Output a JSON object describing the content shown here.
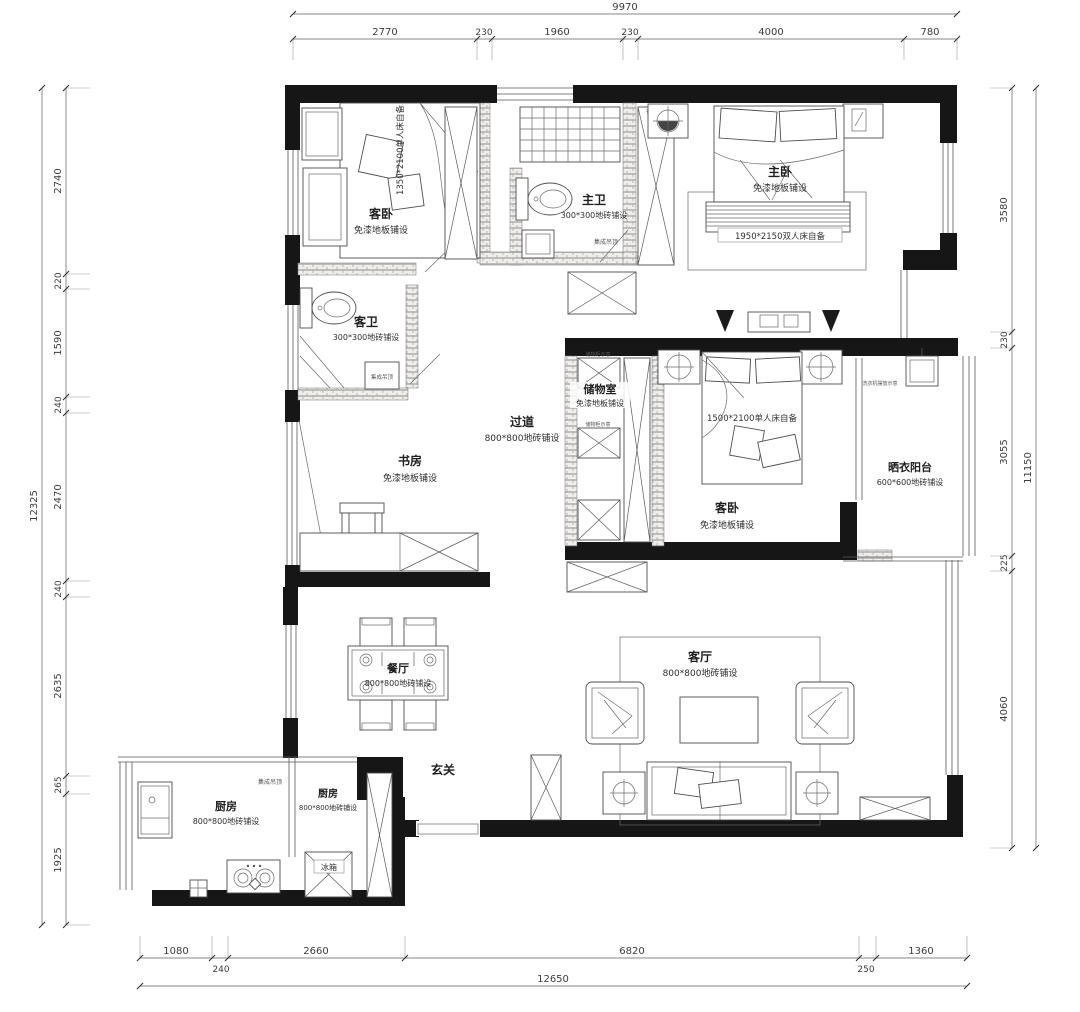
{
  "drawing": {
    "type": "apartment floor plan",
    "wall_color": "#161616",
    "line_color": "#4d4d4d"
  },
  "dimensions": {
    "top": {
      "total": "9970",
      "segments": [
        "2770",
        "230",
        "1960",
        "230",
        "4000",
        "780"
      ]
    },
    "left": {
      "total": "12325",
      "segments": [
        "2740",
        "220",
        "1590",
        "240",
        "2470",
        "240",
        "2635",
        "265",
        "1925"
      ]
    },
    "right": {
      "total": "11150",
      "segments": [
        "3580",
        "230",
        "3055",
        "225",
        "4060"
      ]
    },
    "bottom": {
      "total": "12650",
      "segments": [
        "1080",
        "240",
        "2660",
        "6820",
        "250",
        "1360"
      ]
    }
  },
  "rooms": {
    "guest_bedroom_1": {
      "name": "客卧",
      "finish": "免漆地板铺设",
      "bed_note": "1350*2100单人床自备"
    },
    "master_bath": {
      "name": "主卫",
      "finish": "300*300地砖铺设",
      "ceiling": "集成吊顶"
    },
    "master_bedroom": {
      "name": "主卧",
      "finish": "免漆地板铺设",
      "bed_note": "1950*2150双人床自备",
      "wardrobe_note": "衣柜示意"
    },
    "guest_bath": {
      "name": "客卫",
      "finish": "300*300地砖铺设",
      "ceiling": "集成吊顶"
    },
    "corridor": {
      "name": "过道",
      "finish": "800*800地砖铺设"
    },
    "storage": {
      "name": "储物室",
      "finish": "免漆地板铺设",
      "cabinet_note": "储物柜示意"
    },
    "guest_bedroom_2": {
      "name": "客卧",
      "finish": "免漆地板铺设",
      "bed_note": "1500*2100单人床自备"
    },
    "laundry_balcony": {
      "name": "晒衣阳台",
      "finish": "600*600地砖铺设",
      "washer_note": "洗衣机摆放示意"
    },
    "study": {
      "name": "书房",
      "finish": "免漆地板铺设"
    },
    "dining": {
      "name": "餐厅",
      "finish": "800*800地砖铺设"
    },
    "living": {
      "name": "客厅",
      "finish": "800*800地砖铺设"
    },
    "entry": {
      "name": "玄关"
    },
    "kitchen_1": {
      "name": "厨房",
      "finish": "800*800地砖铺设",
      "ceiling": "集成吊顶"
    },
    "kitchen_2": {
      "name": "厨房",
      "finish": "800*800地砖铺设",
      "fridge": "冰箱"
    }
  }
}
